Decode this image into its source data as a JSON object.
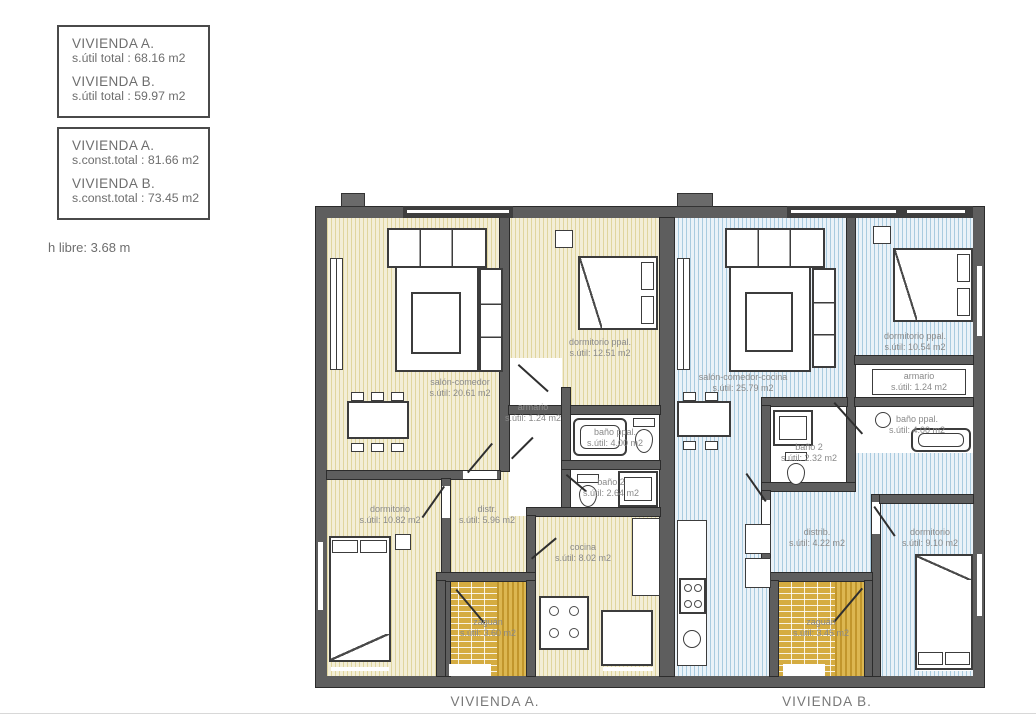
{
  "info": {
    "box_util": {
      "a_title": "VIVIENDA A.",
      "a_value": "s.útil total : 68.16 m2",
      "b_title": "VIVIENDA B.",
      "b_value": "s.útil total : 59.97 m2"
    },
    "box_const": {
      "a_title": "VIVIENDA A.",
      "a_value": "s.const.total : 81.66 m2",
      "b_title": "VIVIENDA B.",
      "b_value": "s.const.total : 73.45 m2"
    },
    "height_note": "h libre: 3.68 m"
  },
  "plan": {
    "a": {
      "caption": "VIVIENDA A.",
      "salon": {
        "name": "salón-comedor",
        "area": "s.útil: 20.61 m2"
      },
      "dorm_ppal": {
        "name": "dormitorio ppal.",
        "area": "s.útil: 12.51 m2"
      },
      "armario": {
        "name": "armario",
        "area": "s.útil: 1.24 m2"
      },
      "bano_ppal": {
        "name": "baño ppal.",
        "area": "s.útil: 4.00 m2"
      },
      "bano2": {
        "name": "baño 2",
        "area": "s.útil: 2.64 m2"
      },
      "dormitorio": {
        "name": "dormitorio",
        "area": "s.útil: 10.82 m2"
      },
      "distr": {
        "name": "distr.",
        "area": "s.útil: 5.96 m2"
      },
      "cocina": {
        "name": "cocina",
        "area": "s.útil: 8.02 m2"
      },
      "zaguan": {
        "name": "zaguán",
        "area": "s.útil: 3.60 m2"
      }
    },
    "b": {
      "caption": "VIVIENDA B.",
      "salon": {
        "name": "salón-comedor-cocina",
        "area": "s.útil: 25.79 m2"
      },
      "dorm_ppal": {
        "name": "dormitorio ppal.",
        "area": "s.útil: 10.54 m2"
      },
      "armario": {
        "name": "armario",
        "area": "s.útil: 1.24 m2"
      },
      "bano_ppal": {
        "name": "baño ppal.",
        "area": "s.útil: 4.00 m2"
      },
      "bano2": {
        "name": "baño 2",
        "area": "s.útil: 2.32 m2"
      },
      "distrib": {
        "name": "distrib.",
        "area": "s.útil: 4.22 m2"
      },
      "dormitorio": {
        "name": "dormitorio",
        "area": "s.útil: 9.10 m2"
      },
      "zaguan": {
        "name": "zaguán",
        "area": "s.útil: 3.45 m2"
      }
    },
    "colors": {
      "wall": "#5e5e5e",
      "wall_dark": "#3e3e3e",
      "floor_a_base": "#f3eed7",
      "floor_a_stripe": "#e0d59e",
      "floor_b_base": "#eaf2f8",
      "floor_b_stripe": "#a9cbdf",
      "zaguan_fill": "#d5ac41",
      "label_text": "#8a8a8a"
    }
  }
}
